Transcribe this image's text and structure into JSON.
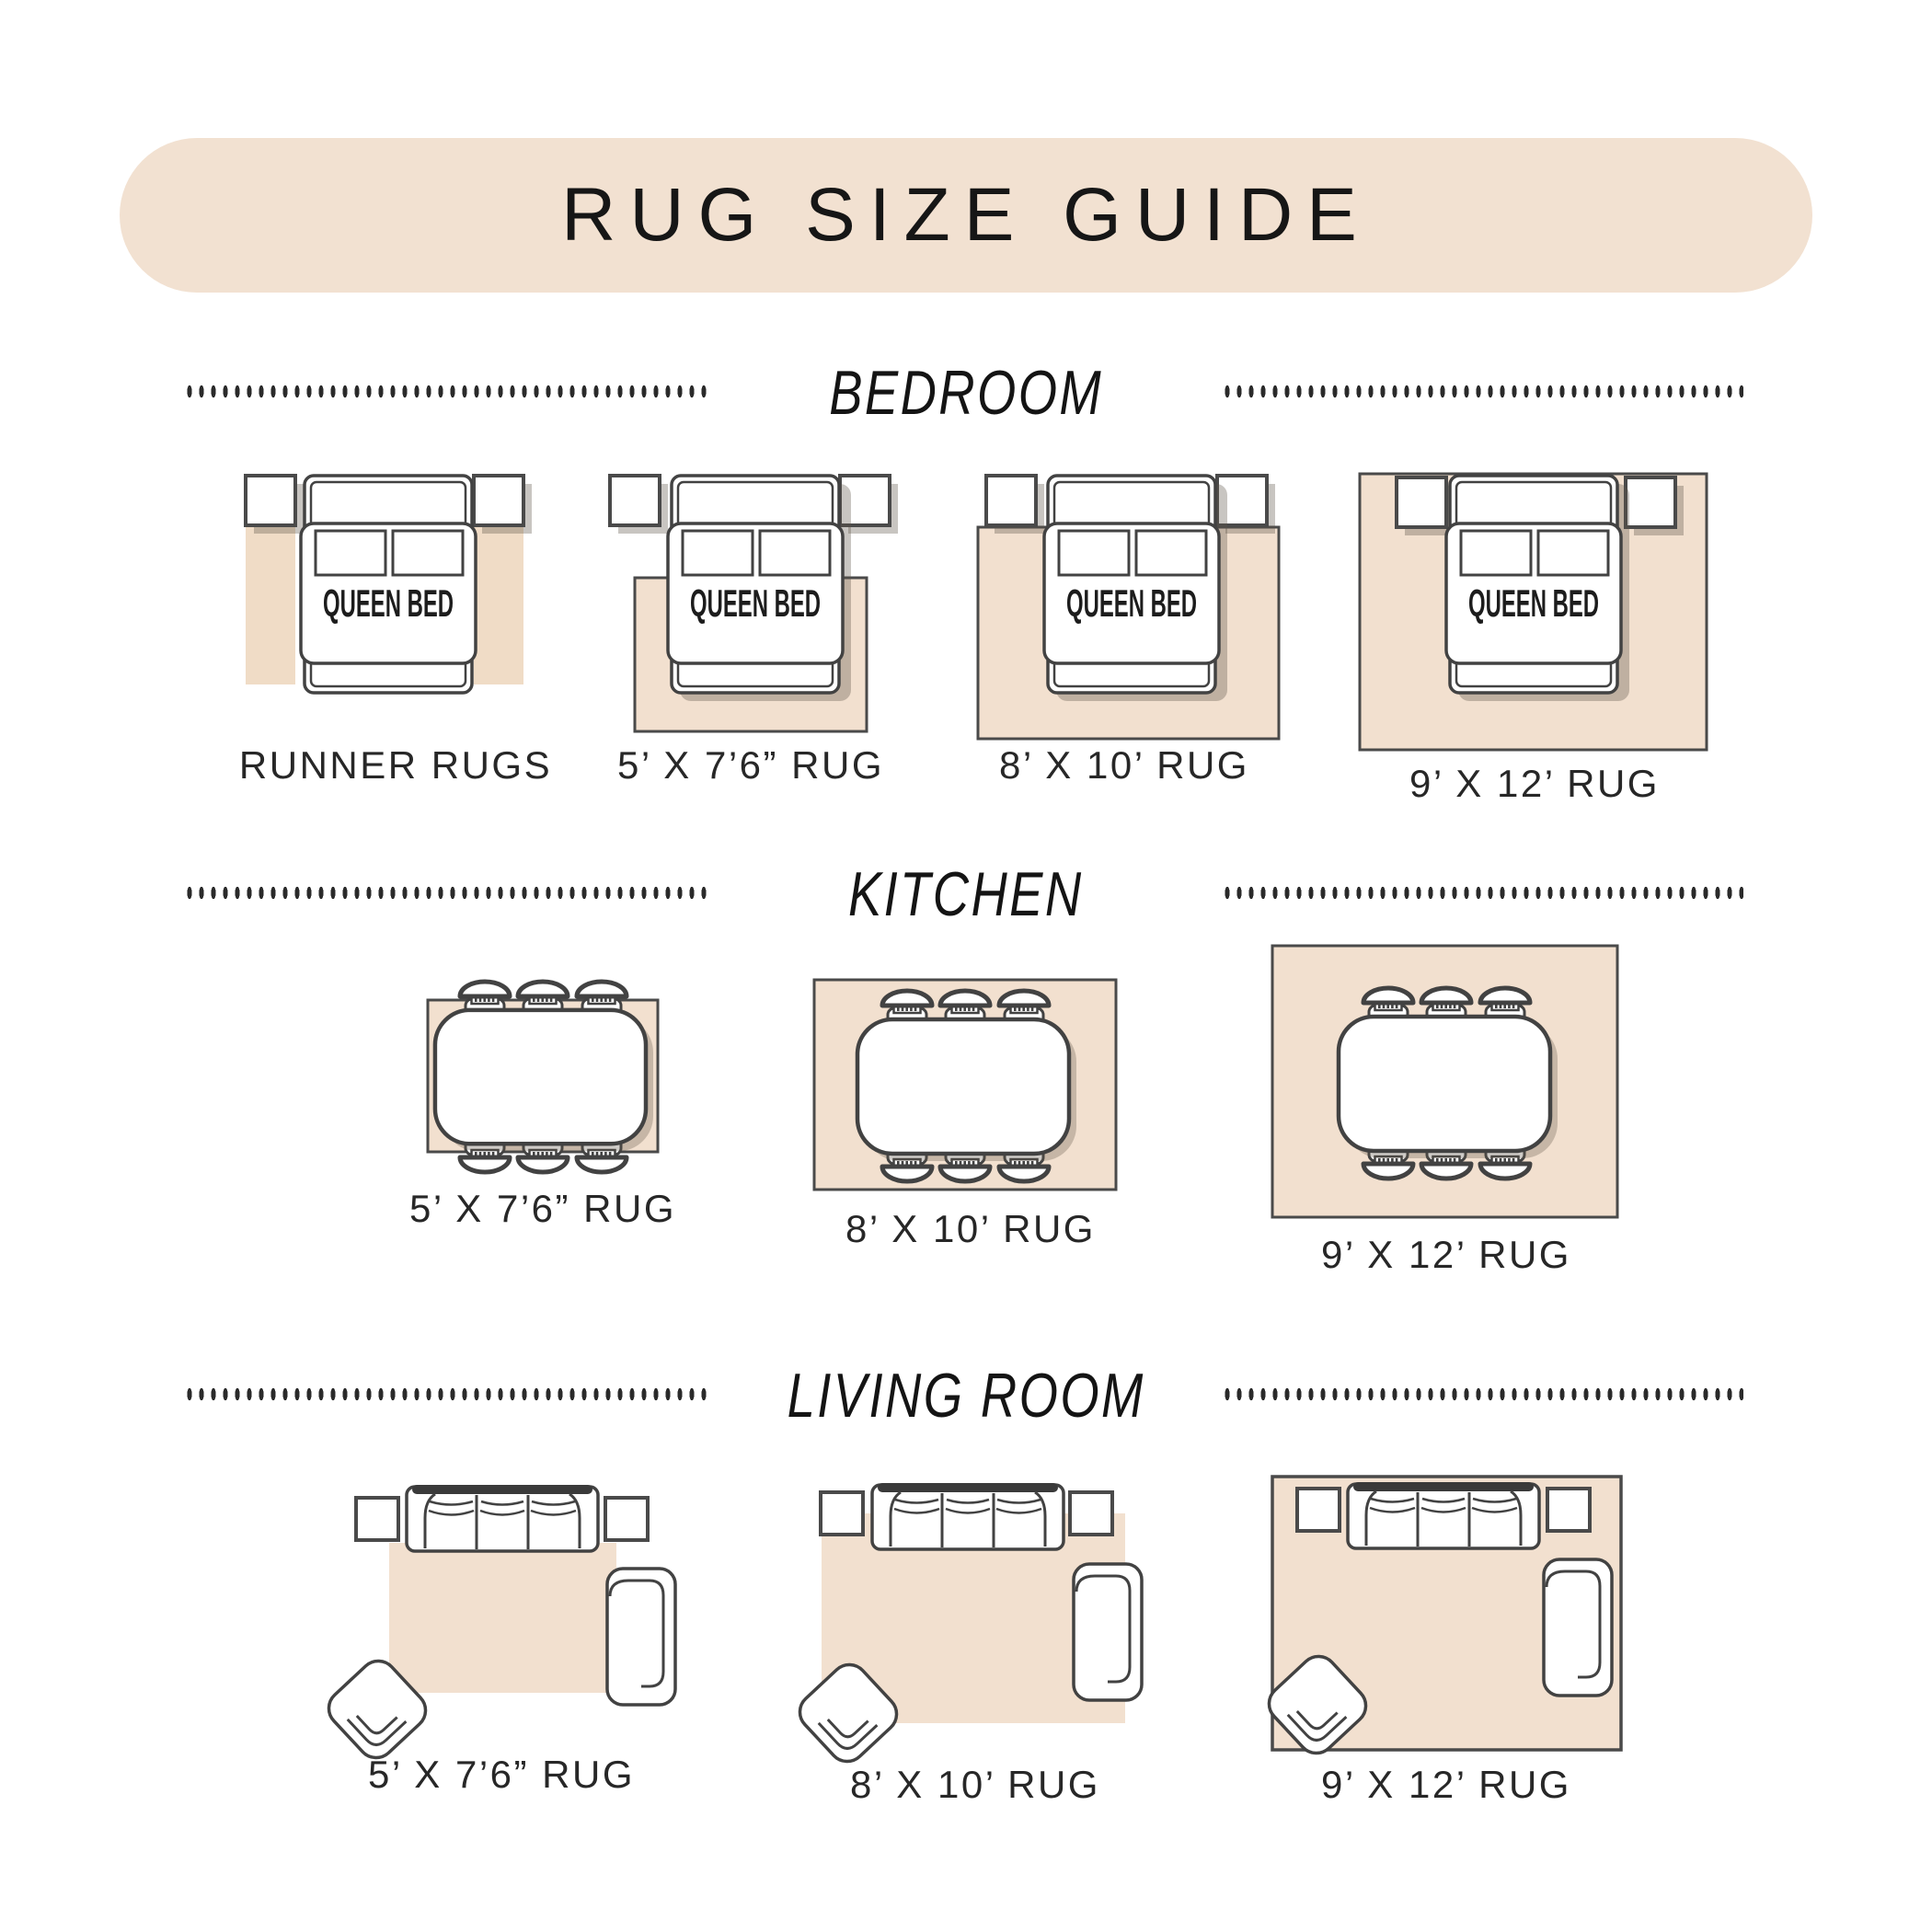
{
  "header": {
    "title": "RUG SIZE GUIDE"
  },
  "bedroom": {
    "title": "BEDROOM",
    "bed_label": "QUEEN BED",
    "items": [
      {
        "label": "RUNNER RUGS"
      },
      {
        "label": "5’ X 7’6” RUG"
      },
      {
        "label": "8’ X 10’ RUG"
      },
      {
        "label": "9’ X 12’ RUG"
      }
    ]
  },
  "kitchen": {
    "title": "KITCHEN",
    "items": [
      {
        "label": "5’ X 7’6” RUG"
      },
      {
        "label": "8’ X 10’ RUG"
      },
      {
        "label": "9’ X 12’ RUG"
      }
    ]
  },
  "living_room": {
    "title": "LIVING ROOM",
    "items": [
      {
        "label": "5’ X 7’6” RUG"
      },
      {
        "label": "8’ X 10’ RUG"
      },
      {
        "label": "9’ X 12’ RUG"
      }
    ]
  },
  "colors": {
    "banner_beige": "#f2e1d1",
    "rug_beige": "#f2e0cf",
    "runner_beige": "#f0dcc6",
    "outline_dark": "#424242",
    "text_dark": "#1c1c1c"
  }
}
